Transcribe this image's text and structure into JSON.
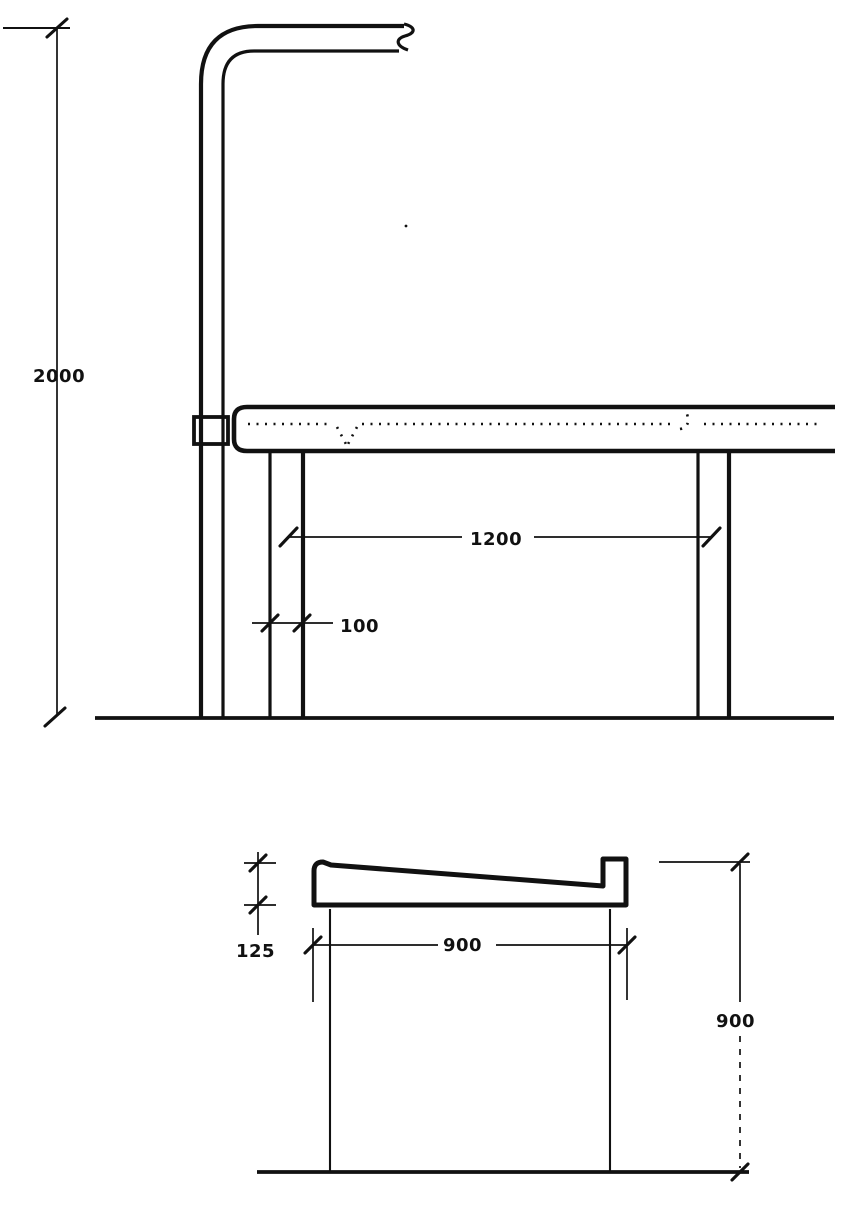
{
  "colors": {
    "ink": "#111111",
    "paper": "#ffffff"
  },
  "dimensions": {
    "elevation": {
      "overall_height": "2000",
      "leg_span": "1200",
      "leg_width": "100"
    },
    "section": {
      "slab_thickness": "125",
      "slab_width": "900",
      "worktop_height": "900"
    }
  }
}
